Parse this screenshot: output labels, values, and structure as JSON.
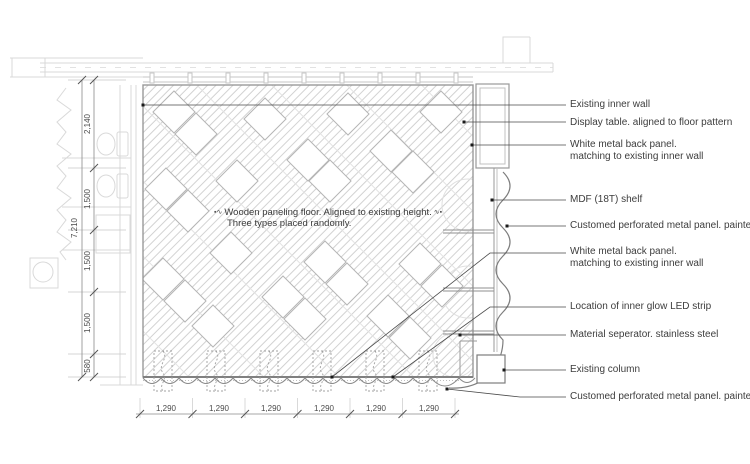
{
  "note": {
    "prefix": "▪∿",
    "suffix": "∿▪",
    "line1": "Wooden paneling floor. Aligned to existing height.",
    "line2": "Three types placed randomly."
  },
  "callouts": [
    {
      "id": "existing-inner-wall",
      "lines": [
        "Existing inner wall"
      ]
    },
    {
      "id": "display-table",
      "lines": [
        "Display table. aligned to floor pattern"
      ]
    },
    {
      "id": "white-metal-back-panel-upper",
      "lines": [
        "White metal back panel.",
        "matching to existing inner wall"
      ]
    },
    {
      "id": "mdf-shelf",
      "lines": [
        "MDF (18T) shelf"
      ]
    },
    {
      "id": "perforated-panel-upper",
      "lines": [
        "Customed perforated metal panel. painted"
      ]
    },
    {
      "id": "white-metal-back-panel-lower",
      "lines": [
        "White metal back panel.",
        "matching to existing inner wall"
      ]
    },
    {
      "id": "led-strip",
      "lines": [
        "Location of inner glow LED strip"
      ]
    },
    {
      "id": "material-separator",
      "lines": [
        "Material seperator. stainless steel"
      ]
    },
    {
      "id": "existing-column",
      "lines": [
        "Existing column"
      ]
    },
    {
      "id": "perforated-panel-lower",
      "lines": [
        "Customed perforated metal panel. painted"
      ]
    }
  ],
  "dimensions": {
    "left_overall": "7,210",
    "left_segments": [
      "2,140",
      "1,500",
      "1,500",
      "1,500",
      "580"
    ],
    "bottom_segments": [
      "1,290",
      "1,290",
      "1,290",
      "1,290",
      "1,290",
      "1,290"
    ]
  },
  "colors": {
    "leader_line": "#4a4a4a",
    "drawing_line": "#8a8a8a",
    "hatch_line": "#d2d2d2",
    "existing_structure": "#d9d9d9",
    "text": "#3d3d3d"
  }
}
